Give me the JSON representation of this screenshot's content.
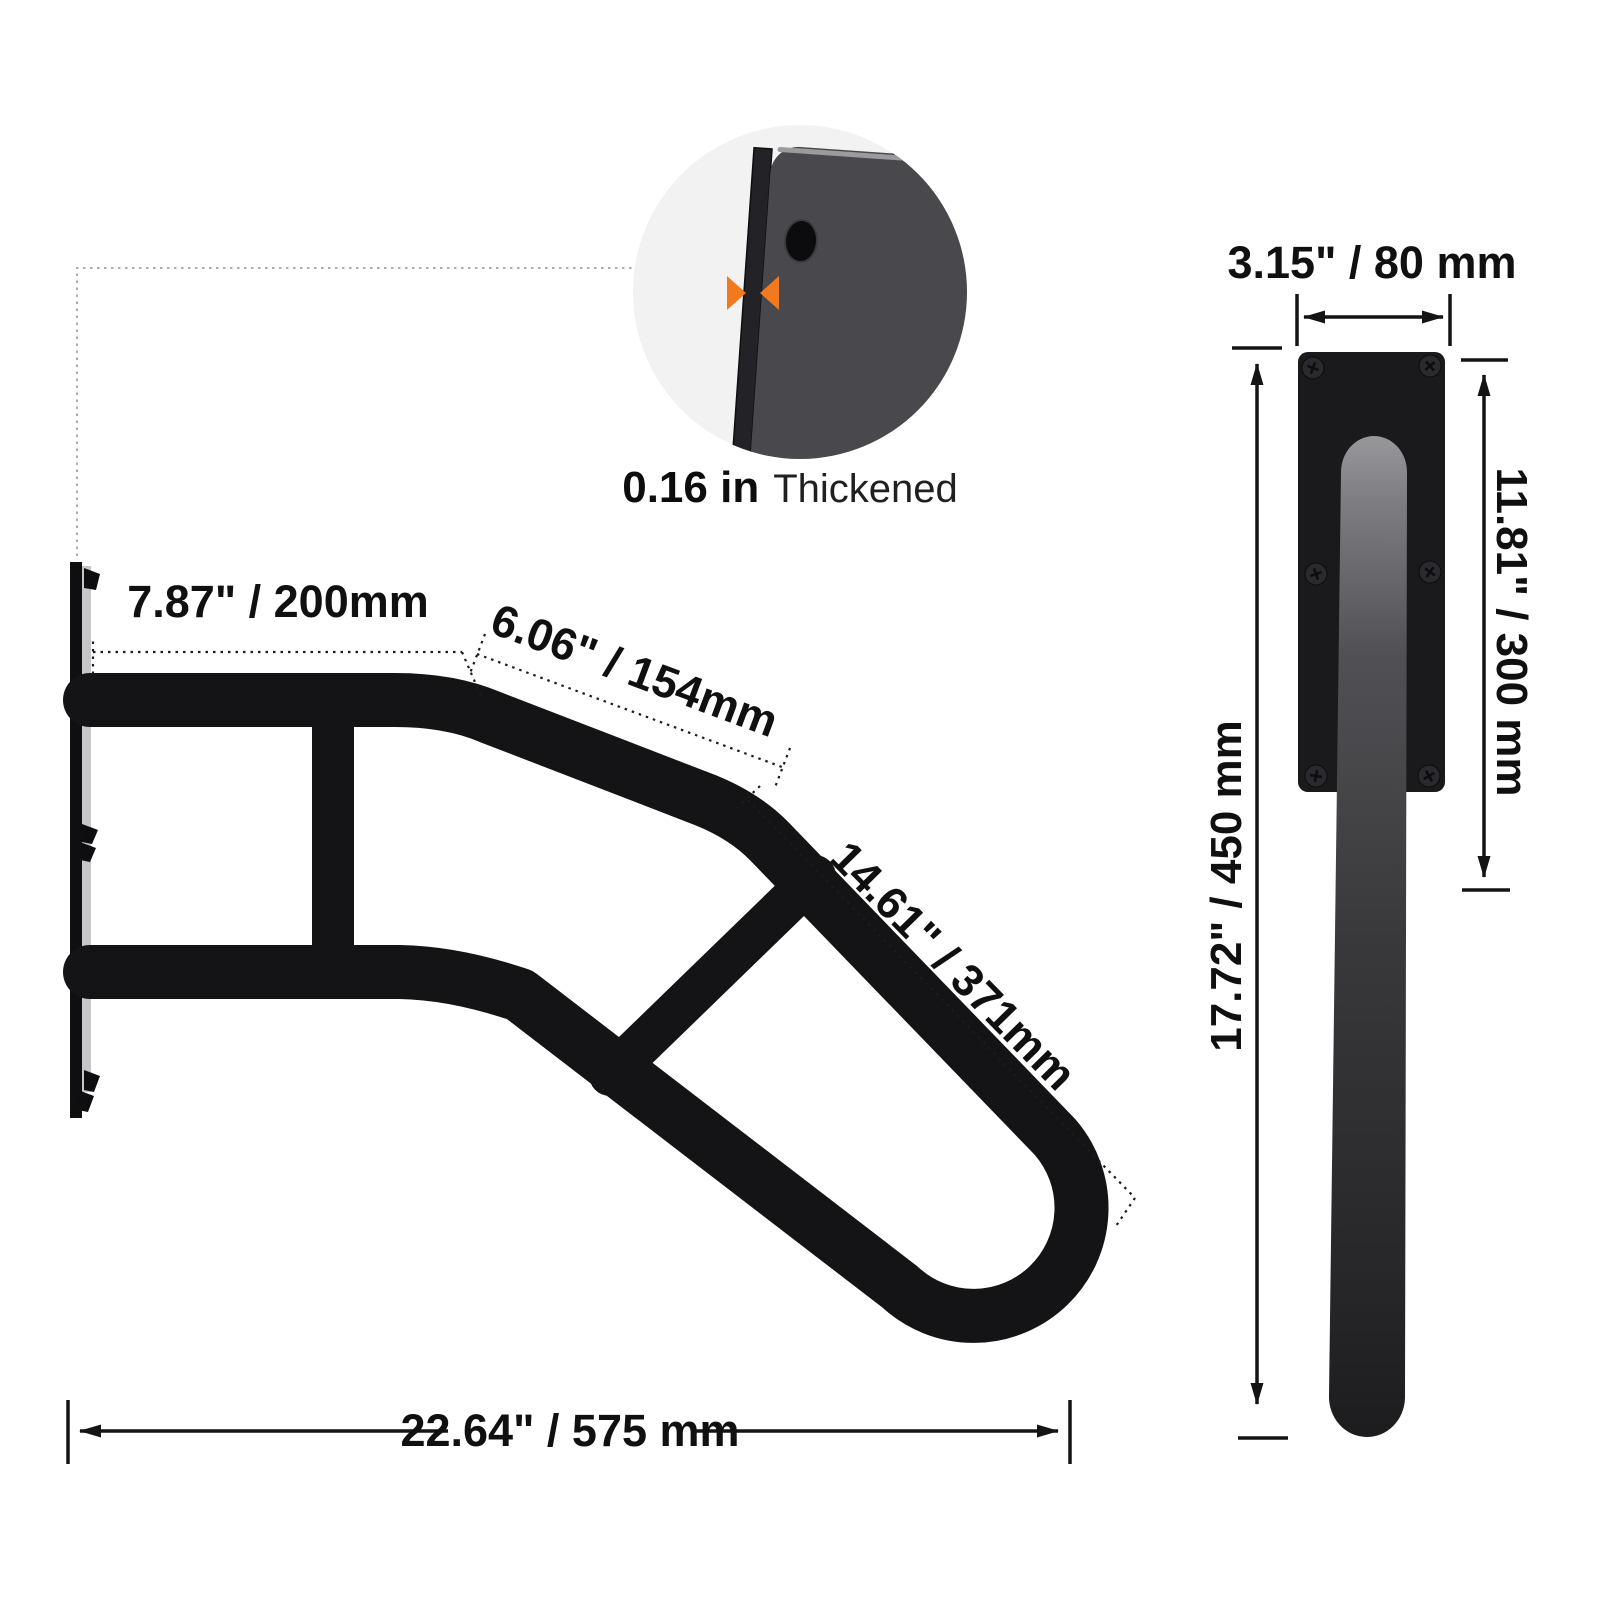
{
  "detail_callout": {
    "thickness_value": "0.16 in",
    "thickness_label": "Thickened"
  },
  "side_view": {
    "dim_top": "7.87\" / 200mm",
    "dim_mid": "6.06\" / 154mm",
    "dim_diag": "14.61\" / 371mm",
    "dim_bottom": "22.64\" / 575 mm"
  },
  "front_view": {
    "dim_width": "3.15\" / 80 mm",
    "dim_inner": "11.81\" / 300 mm",
    "dim_height": "17.72\" / 450 mm"
  },
  "colors": {
    "background": "#ffffff",
    "bar": "#141416",
    "plate_face": "#c6c6ca",
    "detail_plate": "#49494d",
    "detail_bg": "#f2f2f3",
    "accent_orange": "#f2791d",
    "dim": "#141414",
    "leader_gray": "#ababab",
    "front_plate": "#1a1a1c"
  }
}
